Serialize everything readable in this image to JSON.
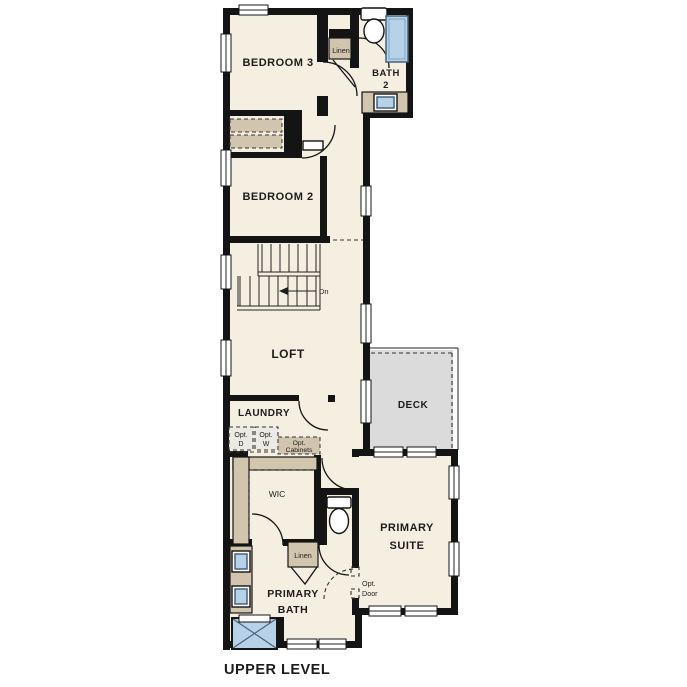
{
  "title": "UPPER LEVEL",
  "rooms": {
    "bedroom3": {
      "label": "BEDROOM 3"
    },
    "bath2": {
      "lines": [
        "BATH",
        "2"
      ]
    },
    "bedroom2": {
      "label": "BEDROOM 2"
    },
    "loft": {
      "label": "LOFT"
    },
    "laundry": {
      "label": "LAUNDRY"
    },
    "deck": {
      "label": "DECK"
    },
    "wic": {
      "label": "WIC"
    },
    "primary_suite": {
      "lines": [
        "PRIMARY",
        "SUITE"
      ]
    },
    "primary_bath": {
      "lines": [
        "PRIMARY",
        "BATH"
      ]
    }
  },
  "annotations": {
    "linen_upper": "Linen",
    "linen_lower": "Linen",
    "stair_direction": "Dn",
    "opt_dryer": {
      "lines": [
        "Opt.",
        "D"
      ]
    },
    "opt_washer": {
      "lines": [
        "Opt.",
        "W"
      ]
    },
    "opt_cabinets": {
      "lines": [
        "Opt.",
        "Cabinets"
      ]
    },
    "opt_door": {
      "lines": [
        "Opt.",
        "Door"
      ]
    }
  },
  "colors": {
    "background": "#ffffff",
    "floor": "#f5efe2",
    "wall": "#141414",
    "cabinetry_tan": "#d2c5ae",
    "fixture_blue": "#b7d2e8",
    "fixture_blue_border": "#46627c",
    "deck_gray": "#dbdbdb",
    "optional_fill": "#eceae4",
    "label_text": "#1c1c1c"
  }
}
